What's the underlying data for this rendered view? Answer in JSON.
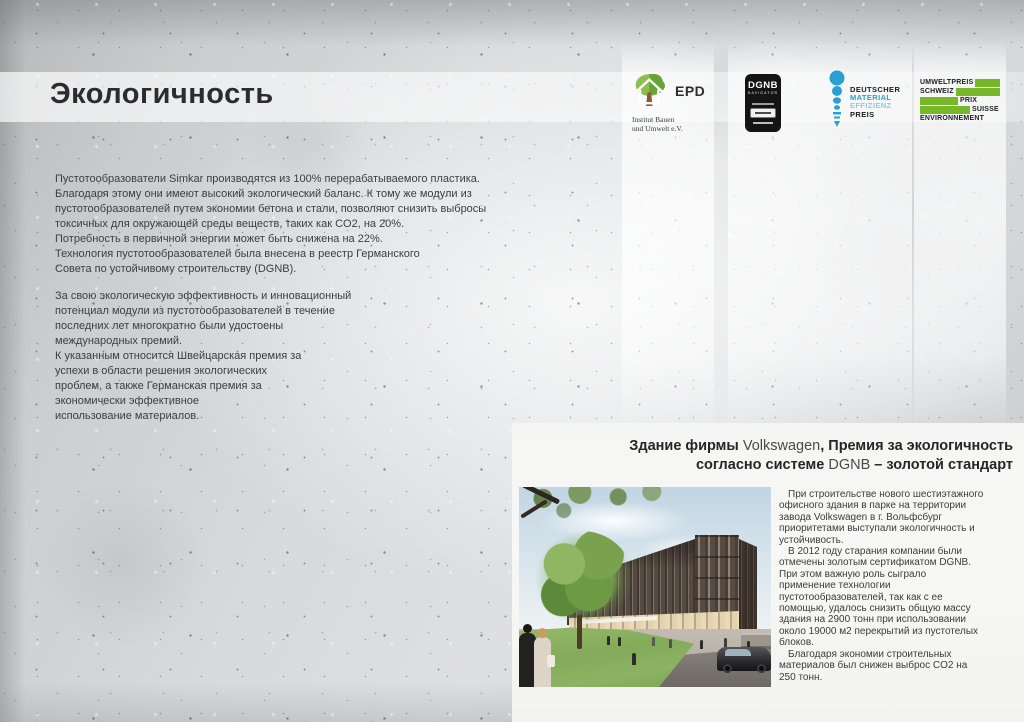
{
  "page": {
    "title": "Экологичность"
  },
  "colors": {
    "epd_green_light": "#8cbf4e",
    "epd_green_dark": "#67a23a",
    "epd_trunk": "#8a5a33",
    "dgnb_black": "#141414",
    "dmep_blue": "#2a9fd4",
    "dmep_blue_light": "#8ec8e3",
    "umwelt_green": "#76b82a",
    "body_text": "#3e3e40",
    "panel_background": "#f6f6f4"
  },
  "logos": {
    "epd": {
      "abbr": "EPD",
      "org": "Institut Bauen\nund Umwelt e.V."
    },
    "dgnb": {
      "name": "DGNB",
      "sub": "NAVIGATOR"
    },
    "dmep": {
      "l1": "DEUTSCHER",
      "l2": "MATERIAL",
      "l3": "EFFIZIENZ",
      "l4": "PREIS"
    },
    "umwelt": {
      "w1": "UMWELTPREIS",
      "w2": "SCHWEIZ",
      "w3": "PRIX",
      "w4": "SUISSE",
      "w5": "ENVIRONNEMENT"
    }
  },
  "intro": {
    "para1": "Пустотообразователи Simkar производятся из 100% перерабатываемого пластика.\nБлагодаря этому они имеют высокий экологический баланс. К тому же модули из\nпустотообразователей путем экономии бетона и стали, позволяют снизить выбросы\nтоксичных для окружающей среды веществ, таких как CO2, на 20%.\nПотребность в первичной энергии может быть снижена на 22%.\nТехнология пустотообразователей была внесена в реестр Германского\nСовета по устойчивому строительству (DGNB).",
    "para2": "За свою экологическую эффективность и инновационный\nпотенциал модули из пустотообразователей в течение\nпоследних лет многократно были удостоены\nмеждународных премий.\nК указанным относится Швейцарская премия за\nуспехи в области решения экологических\nпроблем, а также Германская премия за\nэкономически эффективное\nиспользование материалов."
  },
  "vw": {
    "heading": {
      "b1": "Здание фирмы ",
      "r1": "Volkswagen",
      "b2": ", Премия за экологичность",
      "b3": "согласно системе ",
      "r2": "DGNB",
      "b4": " – золотой стандарт"
    },
    "body1": "При строительстве нового шестиэтажного\nофисного здания в парке на территории\nзавода Volkswagen в г. Вольфсбург\nприоритетами выступали экологичность и\nустойчивость.",
    "body2": "В 2012 году старания компании были\nотмечены золотым сертификатом DGNB.\nПри этом важную роль сыграло\nприменение технологии\nпустотообразователей, так как с ее\nпомощью, удалось снизить общую массу\nздания на 2900 тонн при использовании\nоколо 19000 м2 перекрытий из пустотелых\nблоков.",
    "body3": "Благодаря экономии строительных\nматериалов был снижен выброс CO2 на\n250 тонн."
  }
}
